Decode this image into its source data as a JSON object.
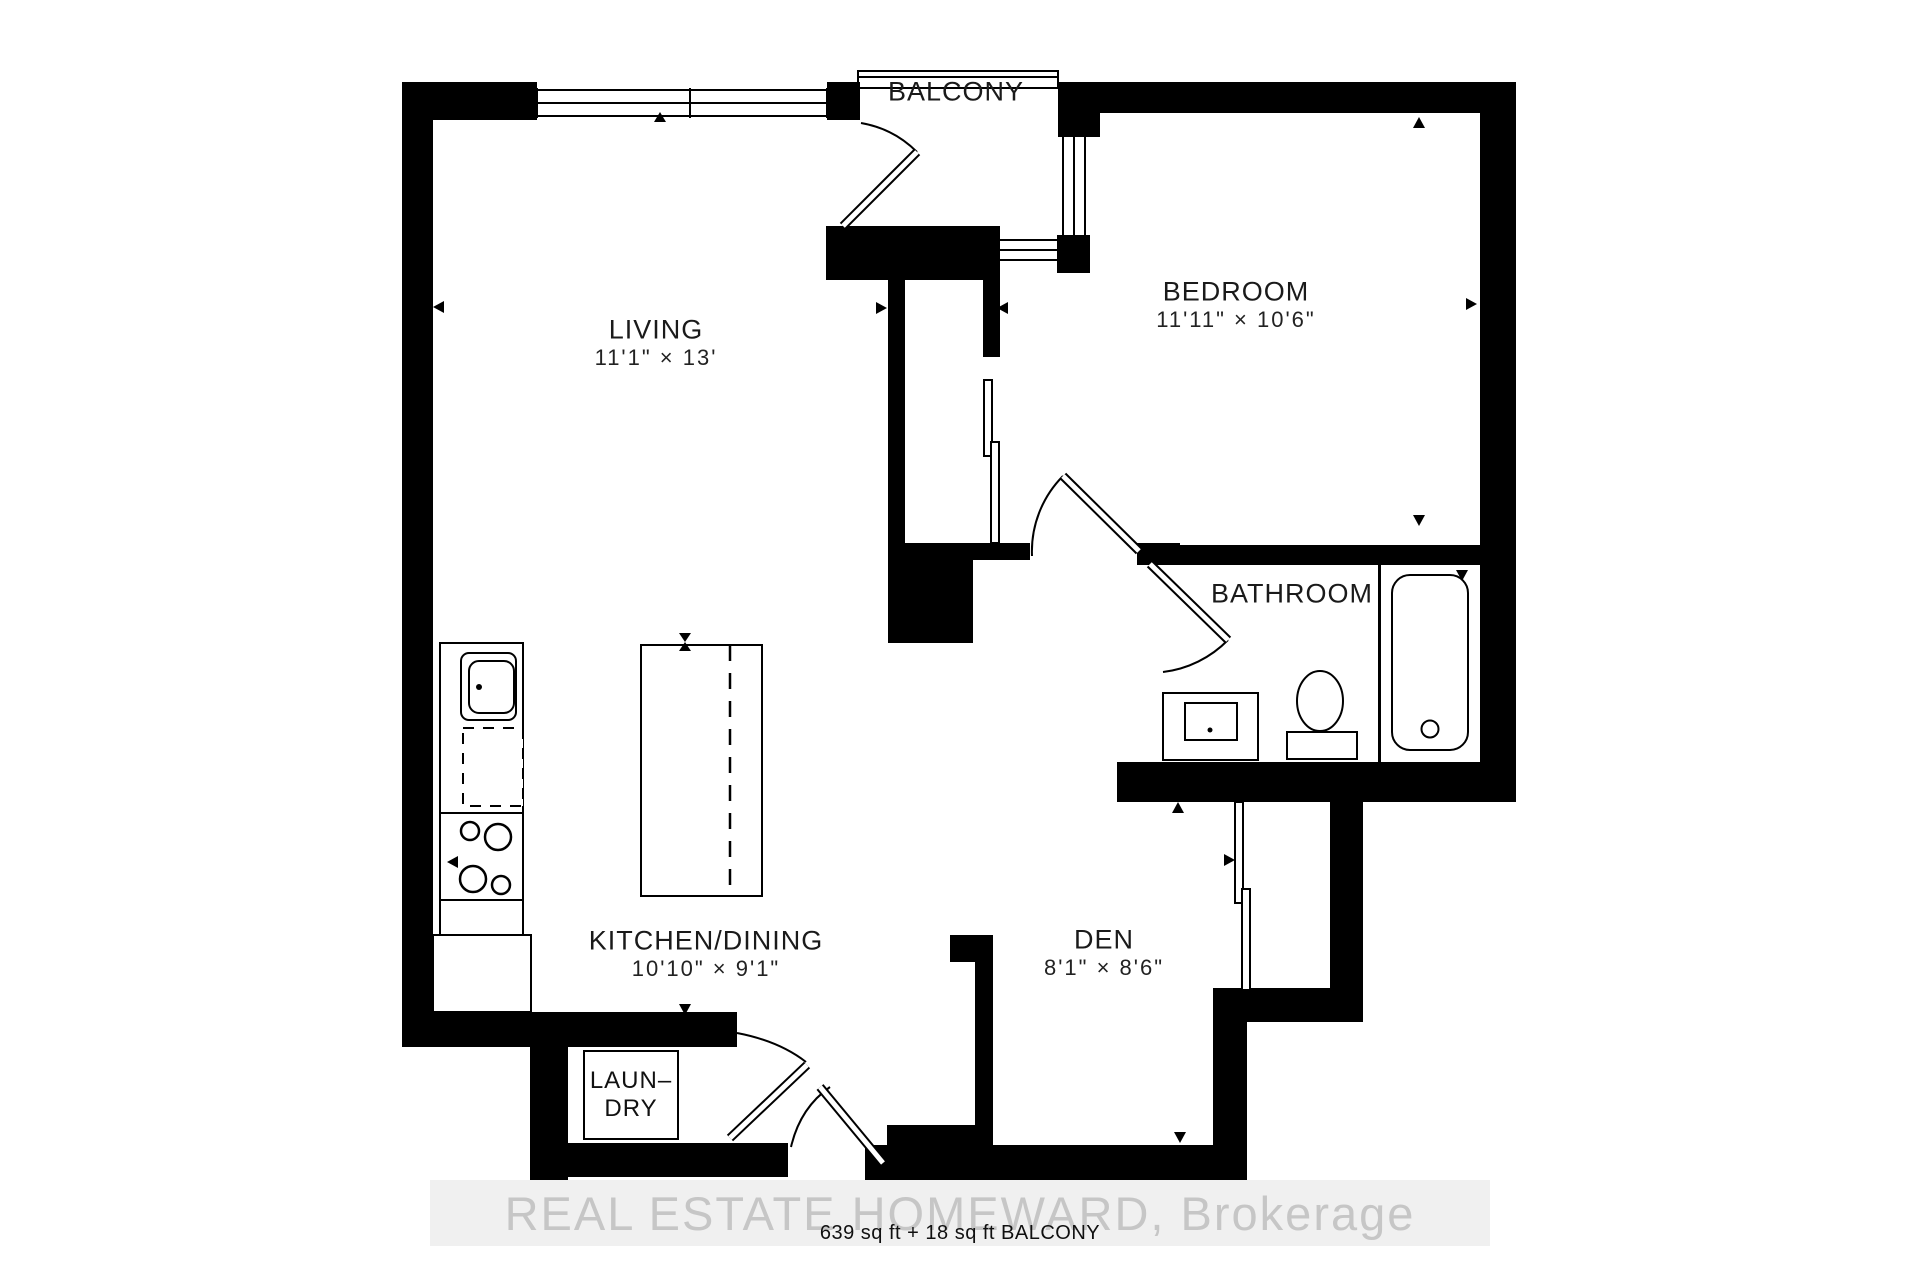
{
  "rooms": {
    "balcony": {
      "label": "BALCONY"
    },
    "living": {
      "label": "LIVING",
      "dim": "11'1\" × 13'"
    },
    "bedroom": {
      "label": "BEDROOM",
      "dim": "11'11\" × 10'6\""
    },
    "bathroom": {
      "label": "BATHROOM"
    },
    "kitchen": {
      "label": "KITCHEN/DINING",
      "dim": "10'10\" × 9'1\""
    },
    "den": {
      "label": "DEN",
      "dim": "8'1\" × 8'6\""
    },
    "laundry": {
      "line1": "LAUN–",
      "line2": "DRY"
    }
  },
  "footer": {
    "watermark": "REAL ESTATE HOMEWARD, Brokerage",
    "area": "639 sq ft + 18 sq ft BALCONY"
  },
  "colors": {
    "wall": "#000000",
    "line": "#000000",
    "watermark_text": "#c6c6c6"
  }
}
